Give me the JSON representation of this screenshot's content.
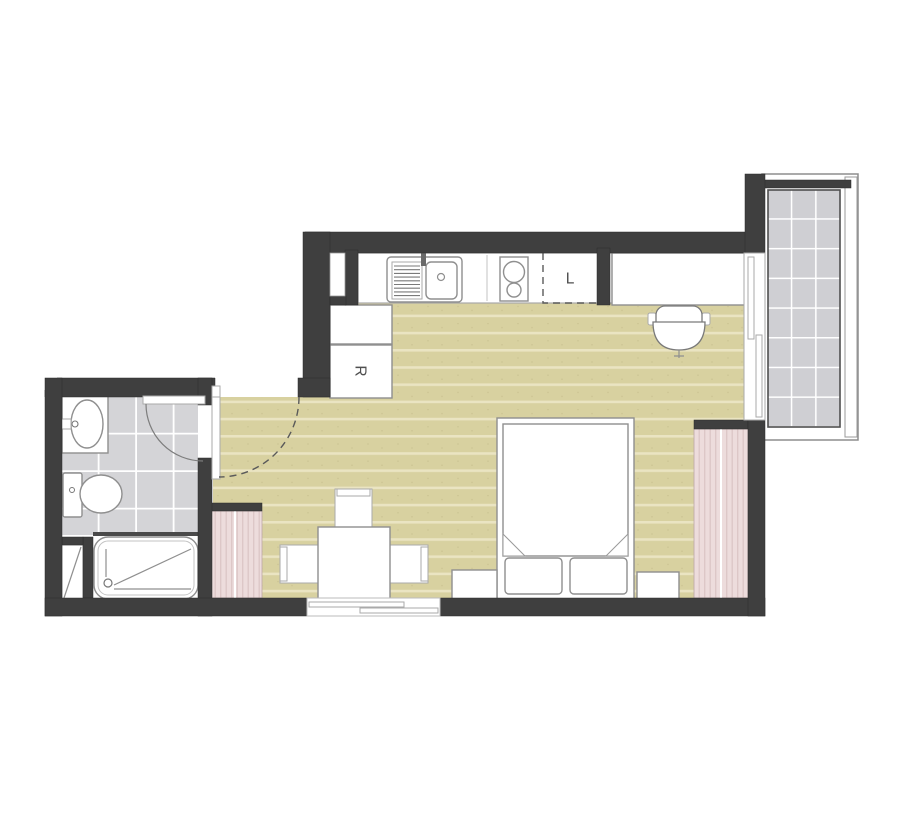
{
  "plan": {
    "labels": {
      "refrigerator": "R",
      "laundry_appliance": "L"
    },
    "colors": {
      "wall": "#3f3f3f",
      "wood_floor": "#d8d1a0",
      "wood_stripe": "#eae4c2",
      "bathroom_tile": "#d4d4d7",
      "balcony_tile": "#cfcfd3",
      "wardrobe": "#eddcdc",
      "wardrobe_stripe": "#ddc7c7",
      "background": "#ffffff"
    }
  }
}
